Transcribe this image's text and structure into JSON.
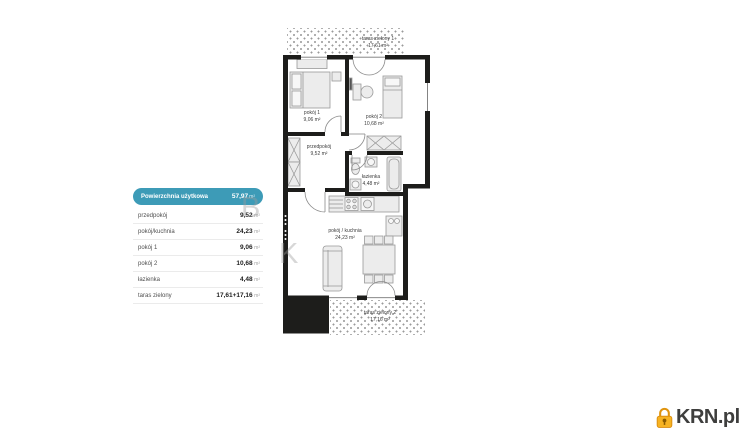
{
  "table": {
    "title": {
      "label": "Powierzchnia użytkowa",
      "value": "57,97",
      "unit": "m²"
    },
    "rows": [
      {
        "label": "przedpokój",
        "value": "9,52",
        "unit": "m²"
      },
      {
        "label": "pokój/kuchnia",
        "value": "24,23",
        "unit": "m²"
      },
      {
        "label": "pokój 1",
        "value": "9,06",
        "unit": "m²"
      },
      {
        "label": "pokój 2",
        "value": "10,68",
        "unit": "m²"
      },
      {
        "label": "łazienka",
        "value": "4,48",
        "unit": "m²"
      },
      {
        "label": "taras zielony",
        "value": "17,61+17,16",
        "unit": "m²"
      }
    ]
  },
  "plan": {
    "labels": {
      "taras1": {
        "name": "taras zielony 1",
        "area": "17,61 m²"
      },
      "pokoj1": {
        "name": "pokój 1",
        "area": "9,06 m²"
      },
      "pokoj2": {
        "name": "pokój 2",
        "area": "10,68 m²"
      },
      "przedpokoj": {
        "name": "przedpokój",
        "area": "9,52 m²"
      },
      "lazienka": {
        "name": "łazienka",
        "area": "4,48 m²"
      },
      "salon": {
        "name": "pokój / kuchnia",
        "area": "24,23 m²"
      },
      "taras2": {
        "name": "taras zielony 2",
        "area": "17,16 m²"
      }
    }
  },
  "watermark": {
    "letter1": "B",
    "letter2": "K"
  },
  "logo": {
    "text": "KRN.pl"
  },
  "colors": {
    "accent_teal": "#3d9bb7",
    "wall_black": "#1d1d1b",
    "logo_orange": "#f2a91e",
    "logo_text": "#3e3e3d"
  }
}
